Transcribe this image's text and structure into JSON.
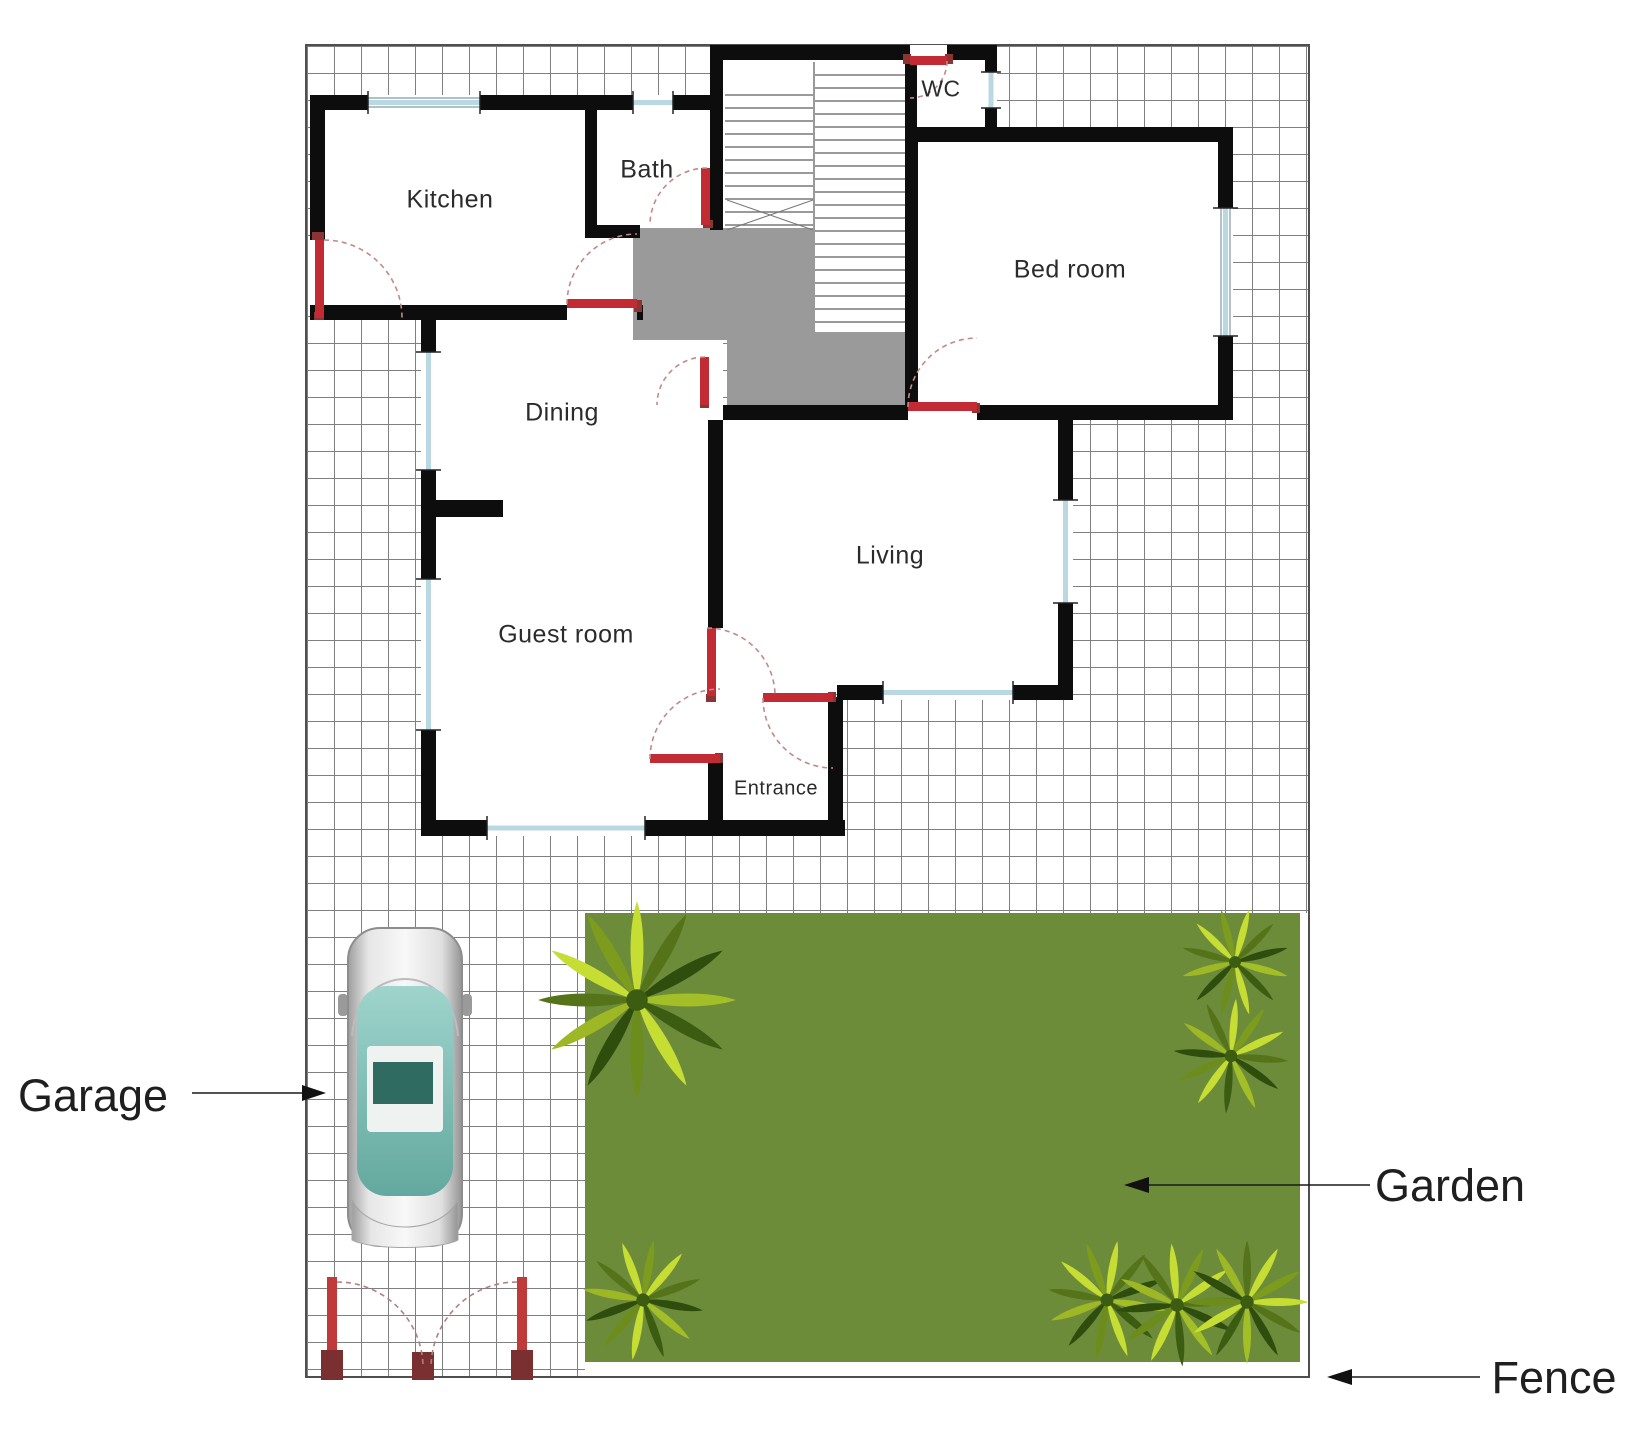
{
  "rooms": {
    "kitchen": "Kitchen",
    "bath": "Bath",
    "wc": "WC",
    "bedroom": "Bed room",
    "dining": "Dining",
    "living": "Living",
    "guest": "Guest room",
    "entrance": "Entrance"
  },
  "annotations": {
    "garage": "Garage",
    "garden": "Garden",
    "fence": "Fence"
  },
  "colors": {
    "wall": "#0d0d0d",
    "door_red": "#c22b33",
    "hall_gray": "#9a9a9a",
    "window_blue": "#b9d8e2",
    "garden_green": "#6d8c3a",
    "palm_bright": "#c6dd33",
    "palm_dark": "#2f4d0d",
    "car_glass_teal": "#7fc2ba",
    "grid_line": "#7f7f7f"
  }
}
